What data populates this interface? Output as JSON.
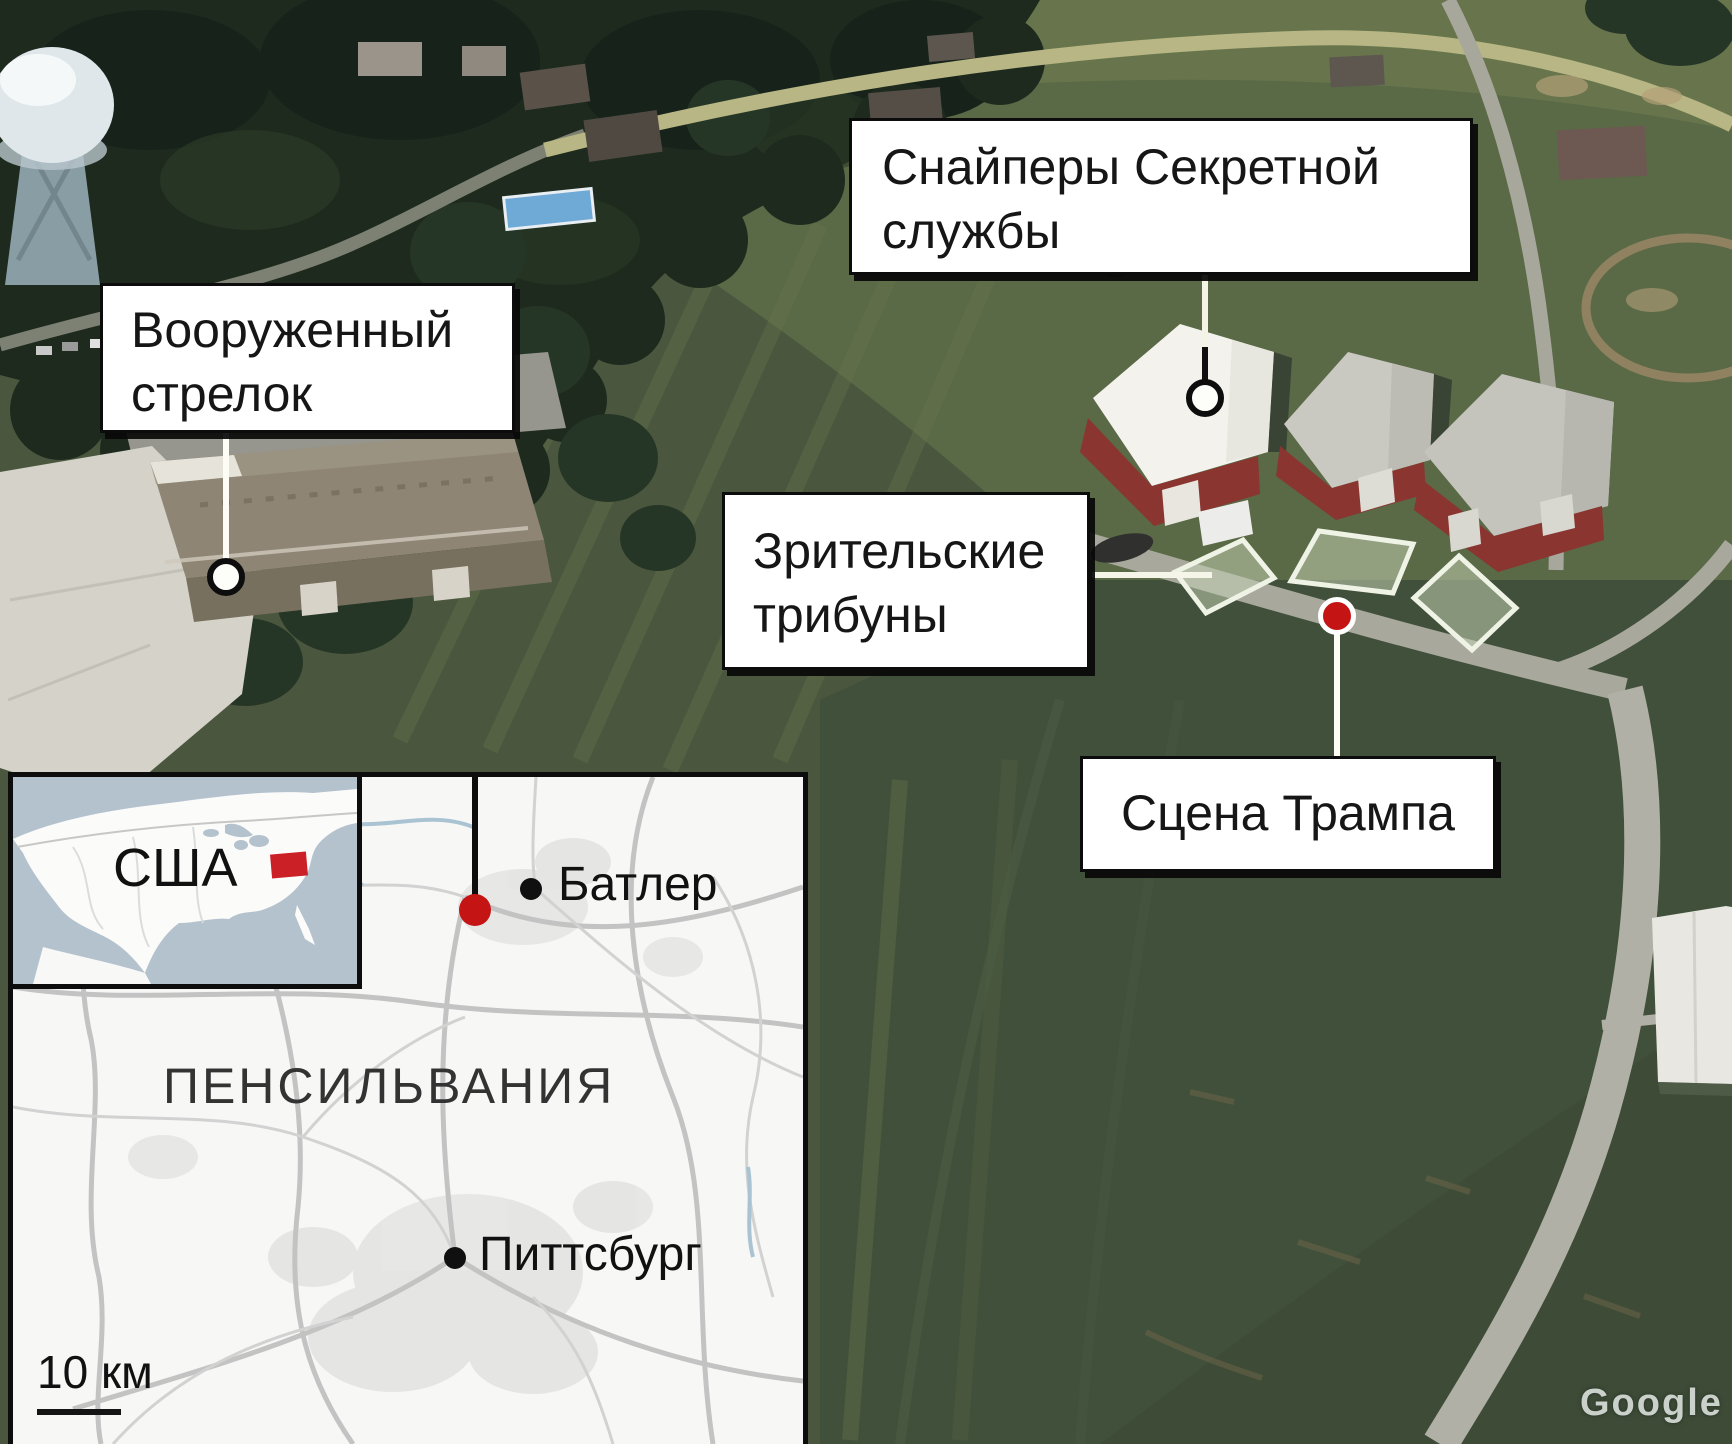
{
  "callouts": {
    "snipers": {
      "line1": "Снайперы Секретной",
      "line2": "службы"
    },
    "shooter": {
      "line1": "Вооруженный",
      "line2": "стрелок"
    },
    "stands": {
      "line1": "Зрительские",
      "line2": "трибуны"
    },
    "stage": {
      "label": "Сцена Трампа"
    }
  },
  "inset_map": {
    "country_label": "США",
    "state_label": "ПЕНСИЛЬВАНИЯ",
    "cities": [
      {
        "name": "Батлер"
      },
      {
        "name": "Питтсбург"
      }
    ],
    "scale_label": "10 км"
  },
  "watermark": "Google",
  "colors": {
    "marker_red": "#c41414",
    "pennsylvania_red": "#cc2027",
    "label_background": "#ffffff",
    "label_text": "#161616"
  }
}
